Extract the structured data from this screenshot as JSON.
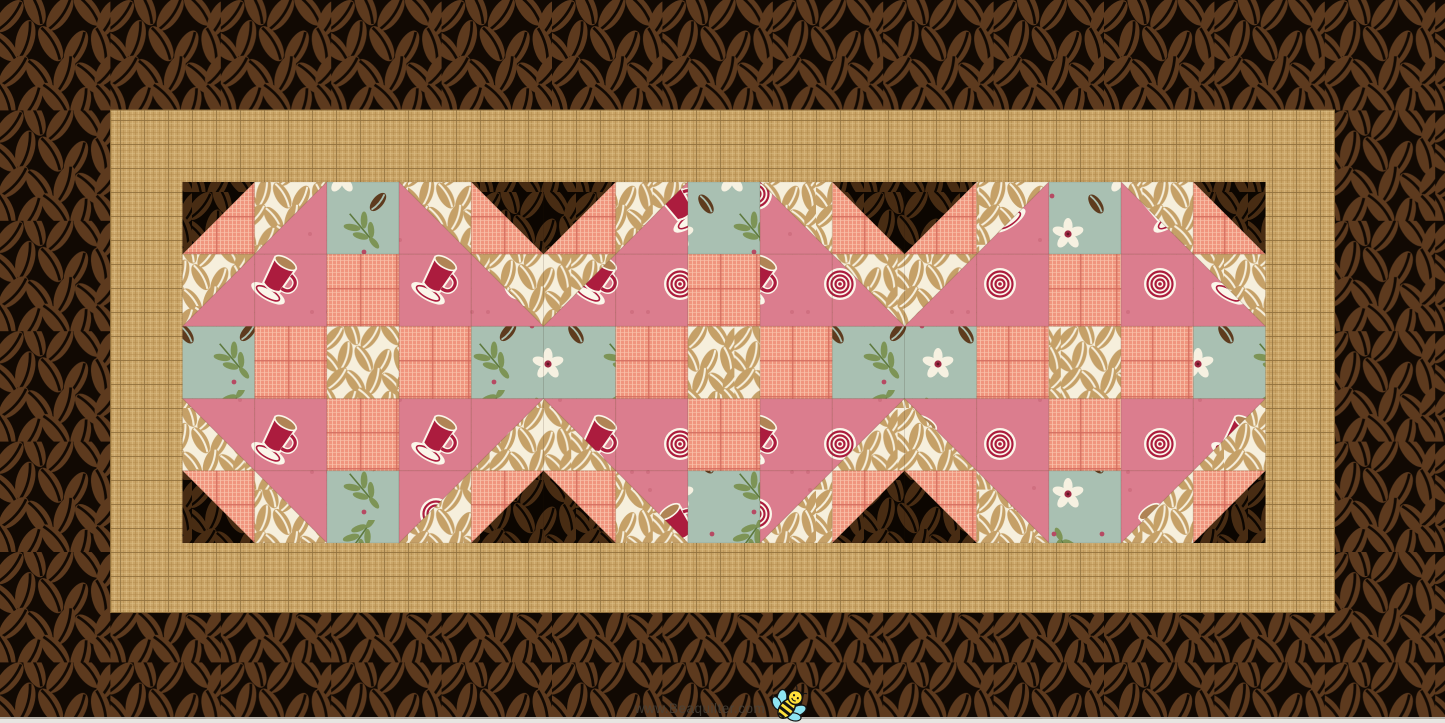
{
  "image": {
    "width": 1445,
    "height": 723,
    "bottom_strip": {
      "line_color": "#b9b6b0",
      "strip_color": "#e7e5e1"
    }
  },
  "watermark": {
    "text": "www.Beaquilter.com",
    "color": "#4a443b",
    "opacity": 0.85,
    "font_size": 13.5,
    "x": 700,
    "y": 713
  },
  "bee": {
    "x": 791,
    "y": 703,
    "rotation": 38,
    "body_yellow": "#ffe13a",
    "wing_cyan": "#8fe5f2",
    "line_black": "#141414"
  },
  "fabrics": {
    "brown_border": {
      "label": "dark coffee bean print (border)",
      "bg": "#110903",
      "bean": "#5d3a1e"
    },
    "brown_dark": {
      "label": "dark coffee bean print (block triangles)",
      "bg": "#0c0601",
      "bean": "#482c13"
    },
    "tan": {
      "label": "tan plaid weave",
      "base": "#c9a467",
      "light": "#ddbe85",
      "dark": "#b18a4b",
      "grid": "#8f6f3c"
    },
    "peach": {
      "label": "peach plaid",
      "base": "#f0957e",
      "light": "#f9c3ab",
      "grid": "#ce6456"
    },
    "pink": {
      "label": "rose coffee-cup print",
      "bg": "#db7d8e",
      "cup": "#ac1c3e",
      "coffee": "#b08455",
      "white": "#fbf6ea",
      "dot": "#d06f80"
    },
    "teal": {
      "label": "teal coffee floral",
      "bg": "#a9c0b2",
      "leaf": "#7d9456",
      "leaf_dark": "#5e7a3e",
      "flower": "#f6f1e1",
      "red": "#9e2742",
      "berry": "#b64a63",
      "bean": "#5e3b1e"
    },
    "cream": {
      "label": "cream coffee bean print",
      "bg": "#f6efdc",
      "bean": "#c5a067"
    }
  },
  "quilt": {
    "square": 72.2,
    "center": {
      "x": 182.5,
      "y": 182,
      "cols": 15,
      "rows": 5
    },
    "tan_border": {
      "x": 110.5,
      "y": 110,
      "w": 1224,
      "h": 502.5
    },
    "blocks_across": 3,
    "block": [
      [
        "hst:/:brown:peach",
        "hst:/:cream:pink",
        "teal",
        "hst:\\:cream:pink",
        "hst:\\:brown:peach"
      ],
      [
        "hst:/:cream:pink",
        "pink",
        "peach",
        "pink",
        "hst:\\:cream:pink"
      ],
      [
        "teal",
        "peach",
        "cream",
        "peach",
        "teal"
      ],
      [
        "hst:\\:pink:cream",
        "pink",
        "peach",
        "pink",
        "hst:/:pink:cream"
      ],
      [
        "hst:\\:peach:brown",
        "hst:\\:pink:cream",
        "teal",
        "hst:/:pink:cream",
        "hst:/:peach:brown"
      ]
    ]
  }
}
